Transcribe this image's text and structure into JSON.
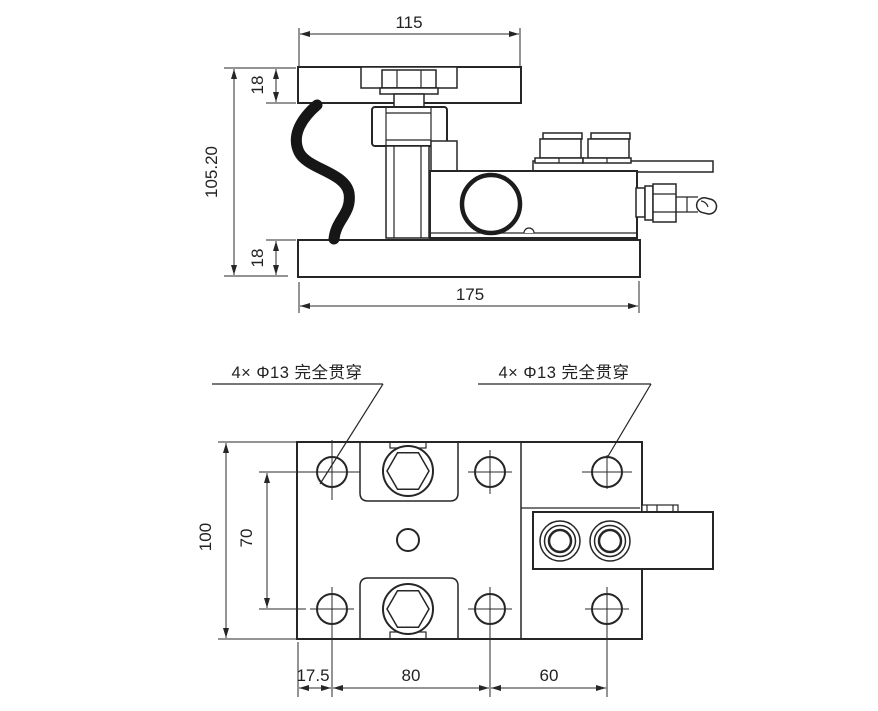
{
  "drawing": {
    "side_view": {
      "dim_width_top": "115",
      "dim_plate_top_thickness": "18",
      "dim_total_height": "105.20",
      "dim_plate_bottom_thickness": "18",
      "dim_base_length": "175"
    },
    "plan_view": {
      "hole_note_left": "4× Φ13 完全贯穿",
      "hole_note_right": "4× Φ13 完全贯穿",
      "dim_plate_width": "100",
      "dim_hole_spacing_vertical": "70",
      "dim_edge_to_hole": "17.5",
      "dim_hole_spacing_horizontal": "80",
      "dim_hole_spacing_right": "60"
    },
    "colors": {
      "line": "#262626",
      "background": "#ffffff"
    }
  }
}
